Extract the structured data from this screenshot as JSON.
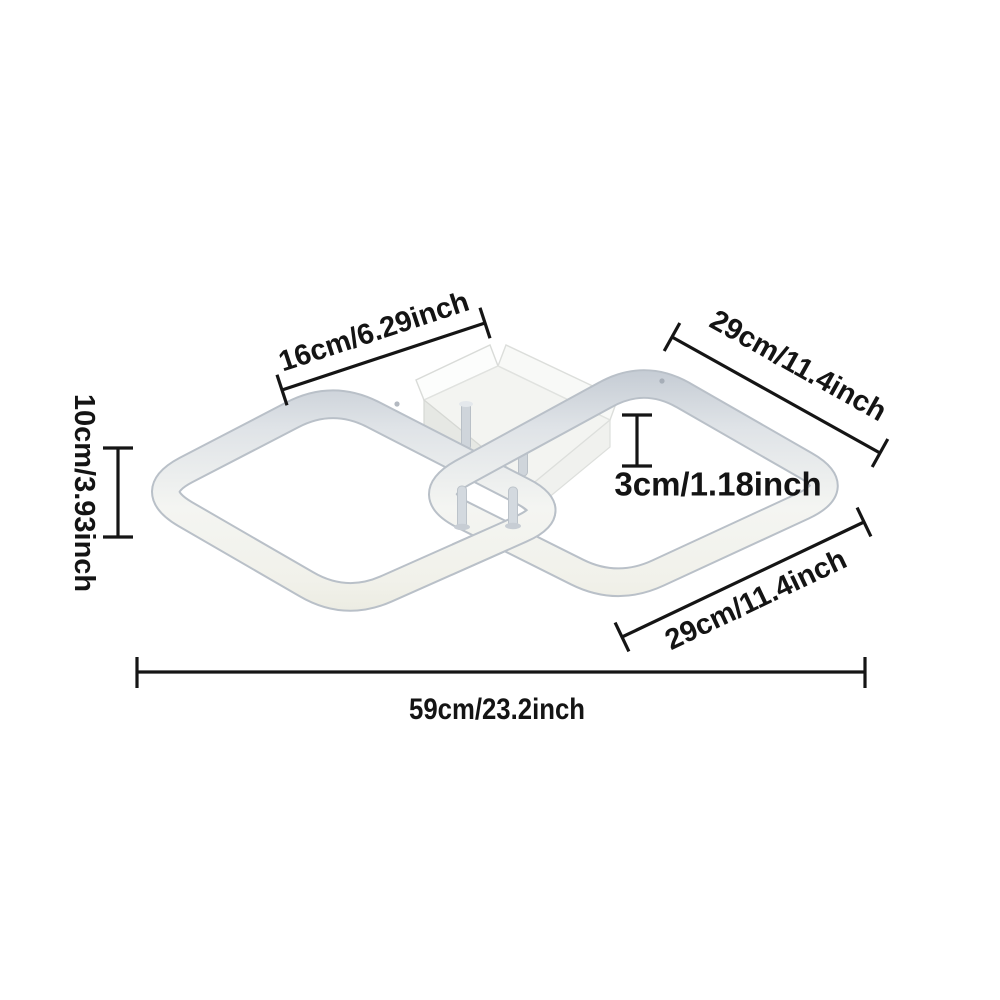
{
  "title": "Ceiling lamp dimension diagram",
  "canvas": {
    "background": "#ffffff",
    "line_color": "#151515",
    "text_color": "#141414"
  },
  "lamp": {
    "type": "two interlocked square LED ring ceiling light with rectangular canopy",
    "colors": {
      "ring_edge": "#b9c0c8",
      "ring_top_shade": "#bac2cc",
      "ring_face": "#f4f5f2",
      "ring_led_stripe": "#e7e7db",
      "canopy_face": "#f3f4f1",
      "canopy_side_shadow": "#e6e8e4",
      "rod": "#d2d8de"
    }
  },
  "dimensions": {
    "canopy_width": {
      "label": "16cm/6.29inch"
    },
    "ring_top_right": {
      "label": "29cm/11.4inch"
    },
    "fixture_height": {
      "label": "10cm/3.93inch"
    },
    "canopy_height": {
      "label": "3cm/1.18inch"
    },
    "ring_bottom_right": {
      "label": "29cm/11.4inch"
    },
    "overall_width": {
      "label": "59cm/23.2inch"
    }
  }
}
